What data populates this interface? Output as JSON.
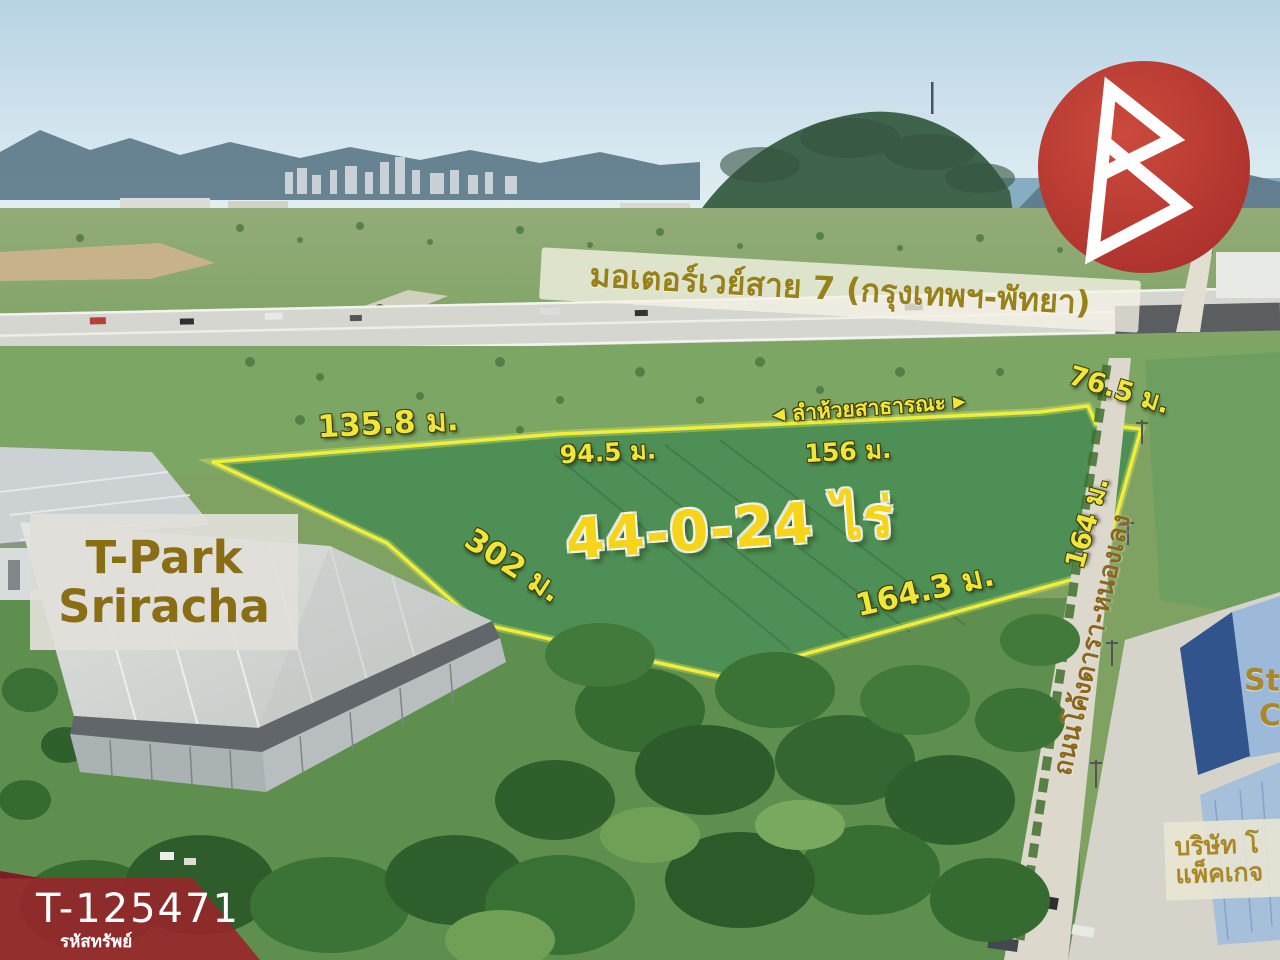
{
  "overlay": {
    "motorway_label": "มอเตอร์เวย์สาย 7 (กรุงเทพฯ-พัทยา)",
    "stream": {
      "left_arrow": "◀",
      "label": "ลำห้วยสาธารณะ",
      "right_arrow": "▶"
    },
    "area_label": "44-0-24 ไร่",
    "measurements": {
      "top_left": "135.8 ม.",
      "top_mid": "94.5 ม.",
      "top_right": "156 ม.",
      "road_upper": "76.5 ม.",
      "road_side": "164 ม.",
      "bottom_right": "164.3 ม.",
      "bottom_left": "302 ม."
    },
    "tpark": {
      "line1": "T-Park",
      "line2": "Sriracha"
    },
    "road_label": "ถนนโค้งดารา-หนองเลง",
    "right_buildings": {
      "partial_line1": "St",
      "partial_line2": "C",
      "company_line1": "บริษัท โ",
      "company_line2": "แพ็คเกจ"
    }
  },
  "badge": {
    "property_code": "T-125471",
    "caption": "รหัสทรัพย์"
  },
  "colors": {
    "boundary_yellow": "#f0ee3c",
    "measurement_yellow": "#efe63a",
    "area_yellow": "#f6d41c",
    "label_gold": "#97811b",
    "banner_red": "#9b232a",
    "logo_red": "#bf3a31",
    "tpark_text": "#8a6e15"
  }
}
